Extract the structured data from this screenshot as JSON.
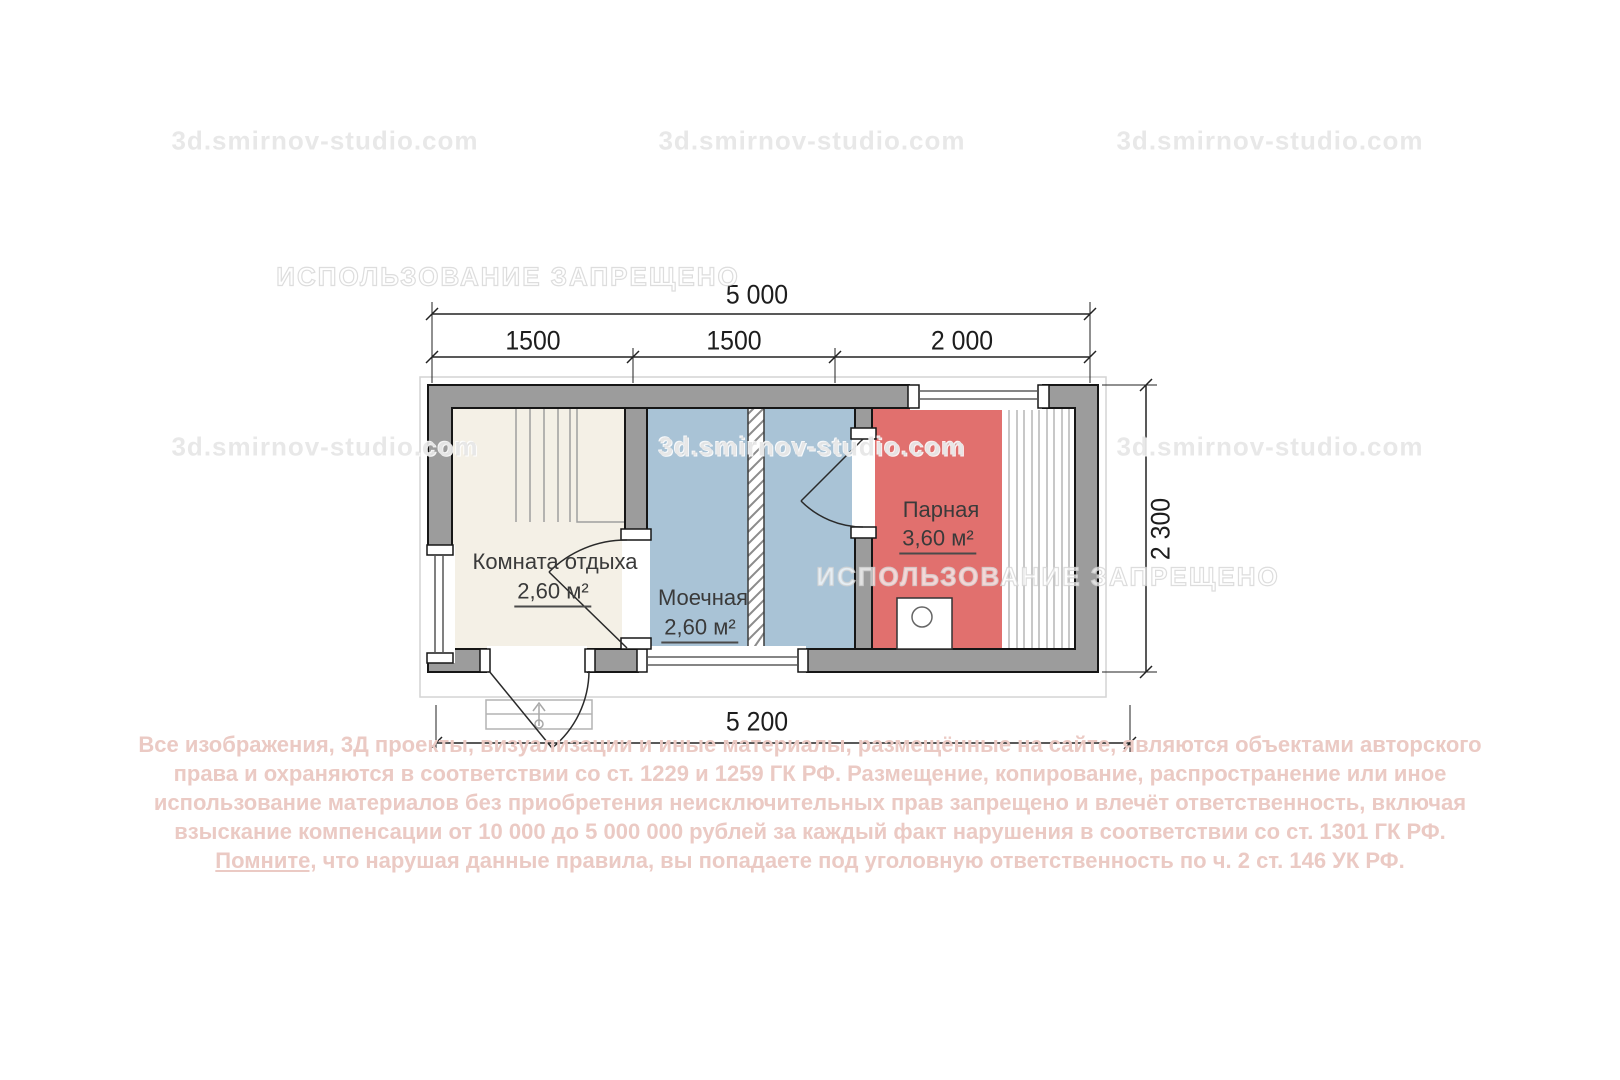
{
  "watermarks": {
    "site": "3d.smirnov-studio.com",
    "forbidden": "ИСПОЛЬЗОВАНИЕ ЗАПРЕЩЕНО"
  },
  "dimensions": {
    "top_total": "5 000",
    "top_segments": [
      "1500",
      "1500",
      "2 000"
    ],
    "right": "2 300",
    "bottom": "5 200"
  },
  "rooms": [
    {
      "name": "Комната отдыха",
      "area": "2,60 м²"
    },
    {
      "name": "Моечная",
      "area": "2,60 м²"
    },
    {
      "name": "Парная",
      "area": "3,60 м²"
    }
  ],
  "colors": {
    "wall": "#9c9c9c",
    "room_rest": "#f4f0e6",
    "room_wash": "#a9c3d6",
    "room_steam": "#e1706e",
    "copyright_text": "#ebcac4"
  },
  "copyright": {
    "line1": "Все изображения, 3Д проекты, визуализации и иные материалы, размещённые на сайте, являются объектами авторского",
    "line2": "права и охраняются в соответствии со ст. 1229 и 1259 ГК РФ. Размещение, копирование, распространение или иное",
    "line3": "использование материалов без приобретения неисключительных прав запрещено и влечёт ответственность, включая",
    "line4": "взыскание компенсации от 10 000 до 5 000 000 рублей за каждый факт нарушения в соответствии со ст. 1301 ГК РФ.",
    "line5_underlined": "Помните,",
    "line5_rest": " что нарушая данные правила, вы попадаете под уголовную ответственность по ч. 2 ст. 146 УК РФ."
  }
}
